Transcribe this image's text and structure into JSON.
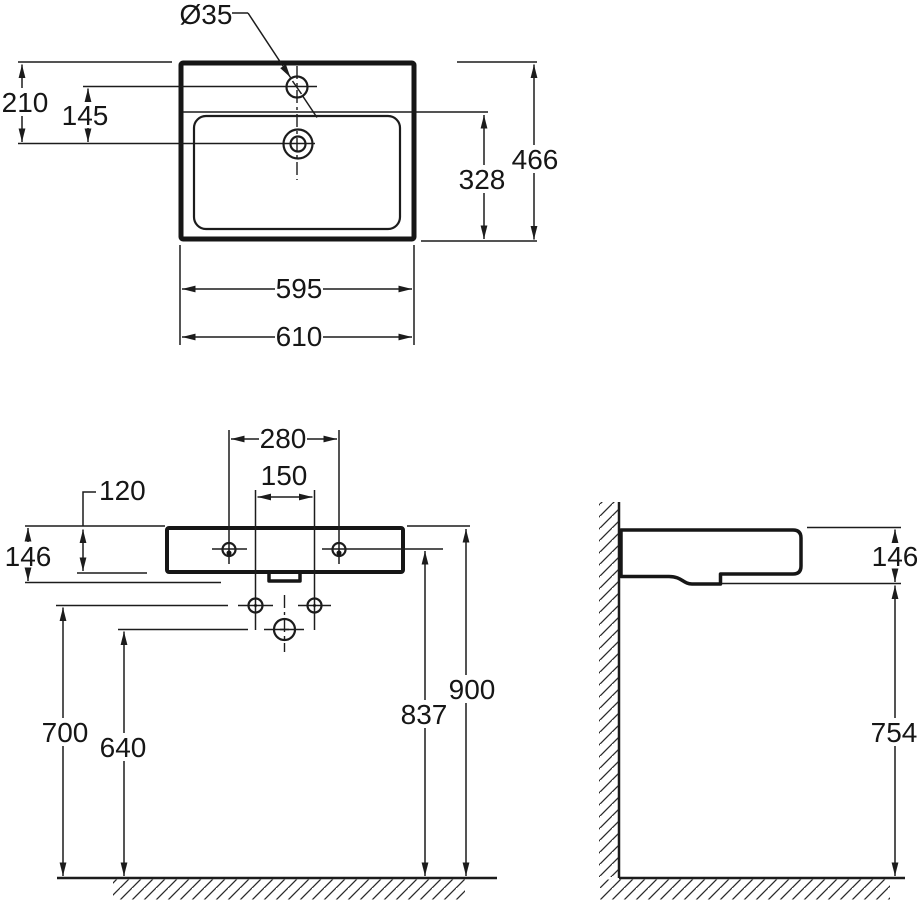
{
  "drawing": {
    "top_view": {
      "faucet_hole_diameter": "Ø35",
      "rim_to_drain": "210",
      "faucet_to_drain": "145",
      "basin_depth": "328",
      "overall_depth": "466",
      "inner_width": "595",
      "overall_width": "610"
    },
    "front_view": {
      "fixing_holes_spacing": "280",
      "supply_holes_spacing": "150",
      "front_apron_height": "120",
      "body_height": "146",
      "supply_height_from_floor": "700",
      "drain_height_from_floor": "640",
      "fixing_height_from_floor": "837",
      "rim_height_from_floor": "900"
    },
    "side_view": {
      "body_height": "146",
      "underside_clearance_height": "754"
    }
  }
}
